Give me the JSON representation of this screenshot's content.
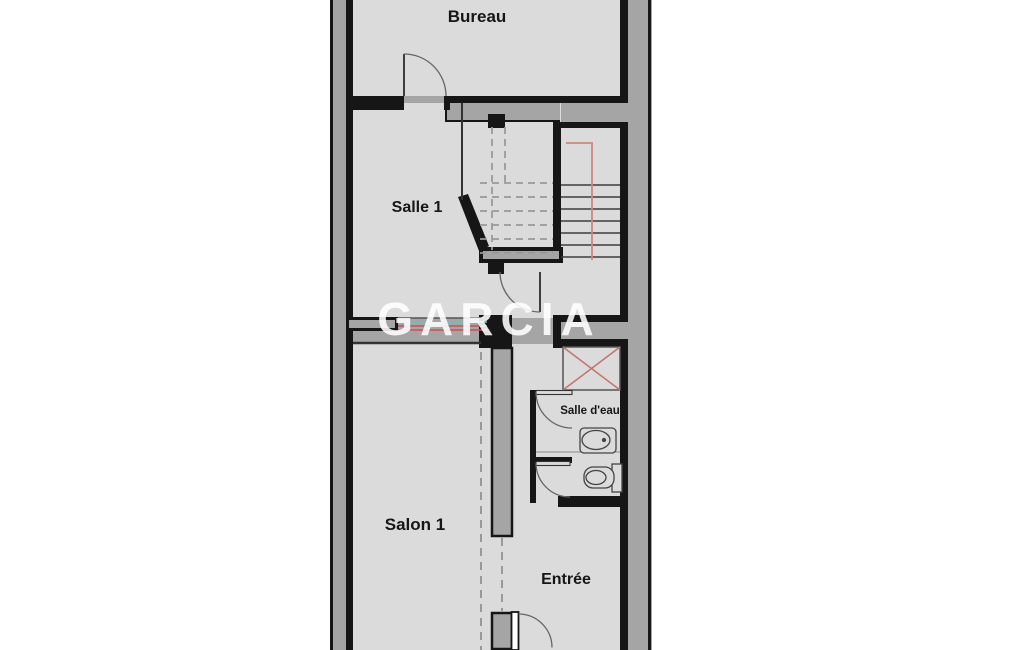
{
  "watermark": {
    "text": "GARCIA",
    "color": "#ffffff"
  },
  "rooms": {
    "bureau": {
      "label": "Bureau"
    },
    "salle1": {
      "label": "Salle 1"
    },
    "salon1": {
      "label": "Salon 1"
    },
    "salle_deau": {
      "label": "Salle d'eau"
    },
    "entree": {
      "label": "Entrée"
    }
  },
  "colors": {
    "outside": "#a5a5a5",
    "floor": "#dbdbdb",
    "wall": "#161616",
    "stair_rail": "#d4837c",
    "shower_cross": "#c4736c",
    "pipe_dark": "#555555",
    "pipe_teal": "#6fbfba",
    "pipe_red": "#cf4f4f",
    "dashed_line": "#999999",
    "stair_tread": "#3c3c3c",
    "door_arc": "#666666",
    "fixture": "#444444"
  }
}
